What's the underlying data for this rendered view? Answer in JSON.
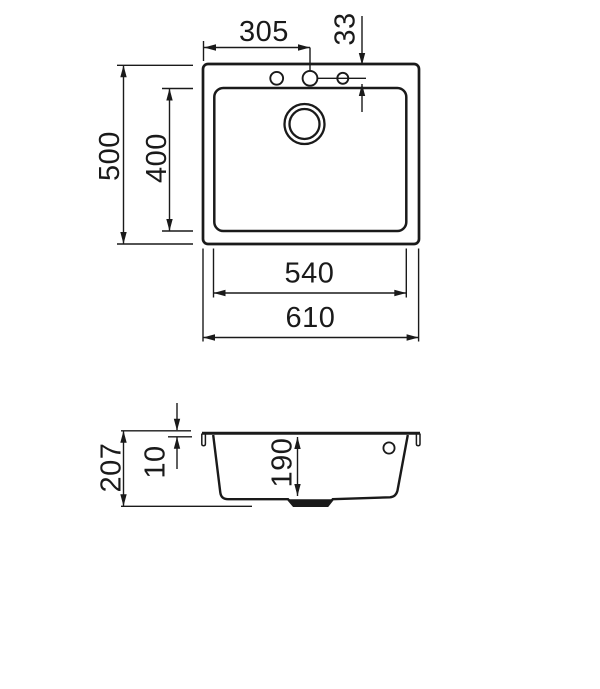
{
  "page": {
    "background": "#ffffff",
    "line_color": "#1a1a1a"
  },
  "views": {
    "top_view": {
      "labels": {
        "faucet_offset": "305",
        "faucet_edge_distance": "33",
        "overall_depth": "500",
        "bowl_depth": "400",
        "bowl_width": "540",
        "overall_width": "610"
      }
    },
    "side_view": {
      "labels": {
        "overall_height": "207",
        "rim_thickness": "10",
        "bowl_inner_depth": "190"
      }
    }
  }
}
